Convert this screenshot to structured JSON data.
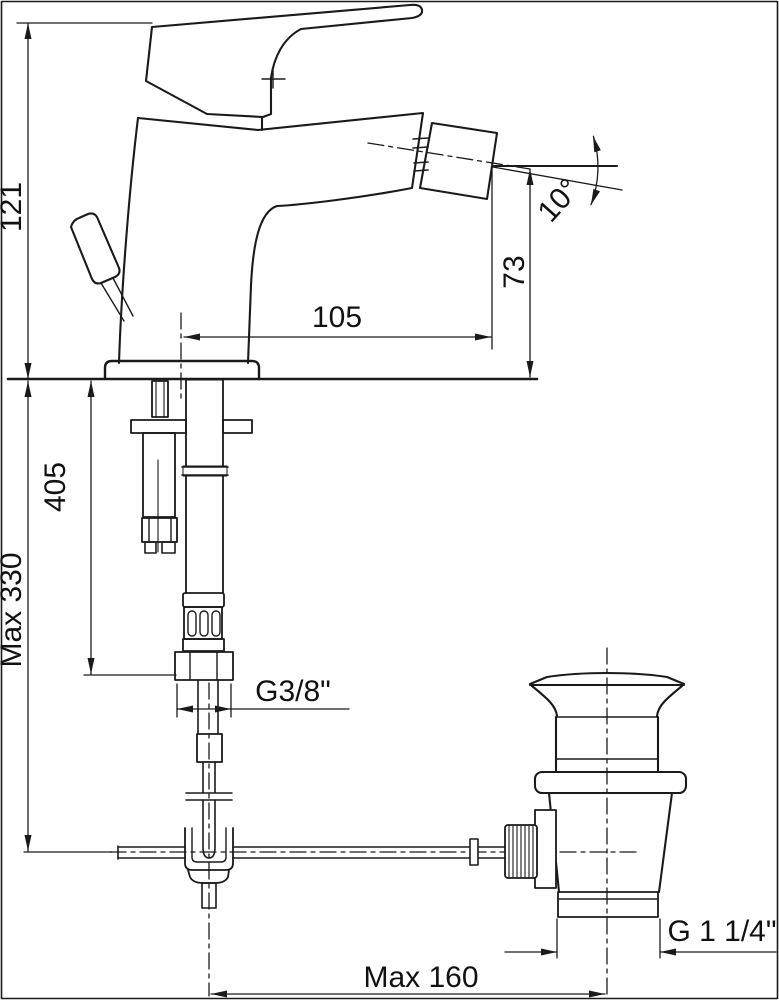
{
  "drawing": {
    "colors": {
      "line": "#1a1a1a",
      "background": "#ffffff"
    }
  },
  "labels": {
    "height_121": "121",
    "reach_105": "105",
    "outlet_height_73": "73",
    "angle_10": "10°",
    "hose_length_405": "405",
    "max_330": "Max 330",
    "supply_thread": "G3/8\"",
    "drain_thread": "G 1 1/4\"",
    "max_160": "Max 160"
  }
}
